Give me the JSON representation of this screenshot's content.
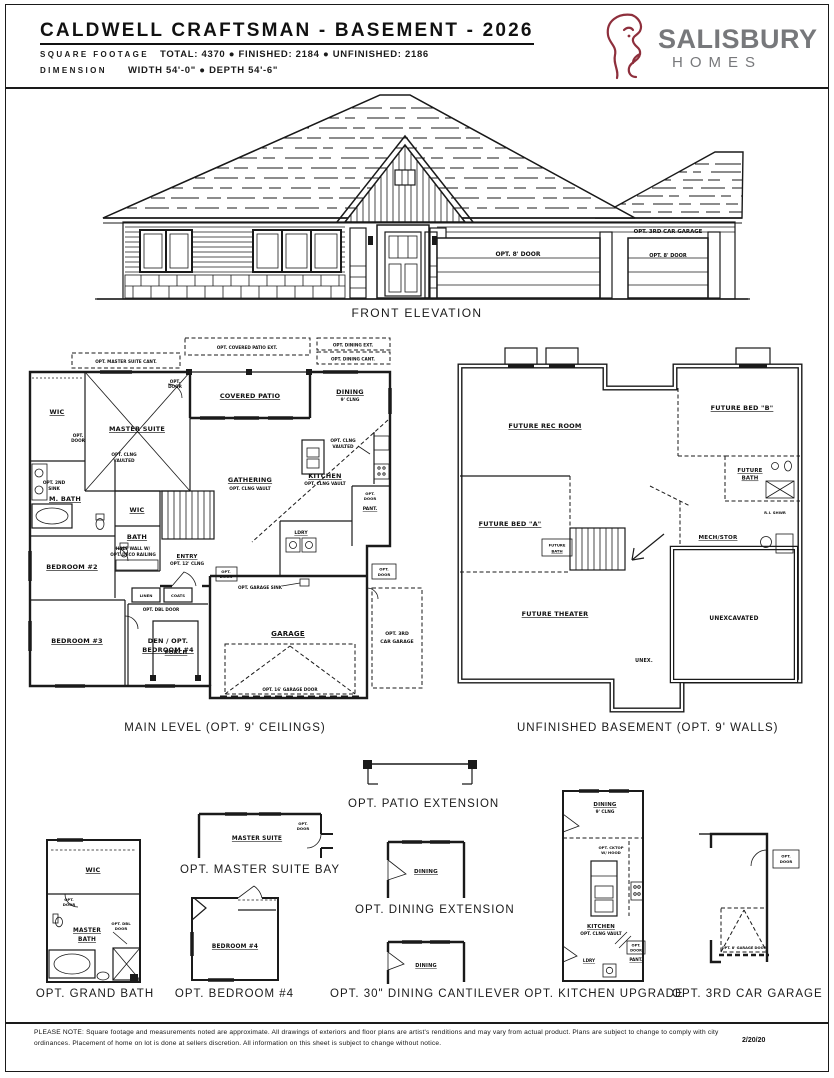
{
  "header": {
    "title": "CALDWELL CRAFTSMAN - BASEMENT - 2026",
    "sqft_label": "SQUARE FOOTAGE",
    "sqft_value": "TOTAL: 4370 ● FINISHED: 2184 ● UNFINISHED: 2186",
    "dim_label": "DIMENSION",
    "dim_value": "WIDTH 54'-0\" ● DEPTH 54'-6\"",
    "brand_name": "SALISBURY",
    "brand_sub": "HOMES",
    "brand_color": "#8e2f3c",
    "brand_text_color": "#77787b"
  },
  "elevation": {
    "caption": "FRONT ELEVATION",
    "opt_3rd_car": "OPT. 3RD CAR GARAGE",
    "opt_door_main": "OPT. 8' DOOR",
    "opt_door_3rd": "OPT. 8' DOOR"
  },
  "main_level": {
    "caption": "MAIN LEVEL (OPT. 9' CEILINGS)",
    "strip_master_cant": "OPT. MASTER SUITE CANT.",
    "strip_patio_ext": "OPT. COVERED PATIO EXT.",
    "strip_dining_ext": "OPT. DINING EXT.",
    "strip_dining_cant": "OPT. DINING CANT.",
    "wic": "WIC",
    "master_suite": "MASTER SUITE",
    "opt_clng_1": "OPT. CLNG",
    "opt_clng_2": "VAULTED",
    "covered_patio": "COVERED PATIO",
    "dining": "DINING",
    "dining_sub": "9' CLNG",
    "gathering": "GATHERING",
    "gathering_sub": "OPT. CLNG VAULT",
    "kitchen": "KITCHEN",
    "kitchen_sub": "OPT. CLNG VAULT",
    "m_bath": "M. BATH",
    "opt_2nd_sink_1": "OPT. 2ND",
    "opt_2nd_sink_2": "SINK",
    "opt_door_1": "OPT.",
    "opt_door_2": "DOOR",
    "wic2": "WIC",
    "bath": "BATH",
    "bedroom2": "BEDROOM #2",
    "bedroom3": "BEDROOM #3",
    "den_1": "DEN / OPT.",
    "den_2": "BEDROOM #4",
    "linen": "LINEN",
    "coats": "COATS",
    "opt_dbl_door": "OPT. DBL DOOR",
    "entry": "ENTRY",
    "entry_sub": "OPT. 12' CLNG",
    "half_wall_1": "HALF WALL W/",
    "half_wall_2": "OPT. DECO RAILING",
    "ldry": "LDRY",
    "pant": "PANT.",
    "garage": "GARAGE",
    "opt_garage_sink": "OPT. GARAGE SINK",
    "opt_garage_door": "OPT. 16' GARAGE DOOR",
    "porch": "PORCH",
    "third_car_1": "OPT. 3RD",
    "third_car_2": "CAR GARAGE"
  },
  "basement": {
    "caption": "UNFINISHED BASEMENT (OPT. 9' WALLS)",
    "rec_room": "FUTURE REC ROOM",
    "bed_b": "FUTURE BED \"B\"",
    "bath_1": "FUTURE",
    "bath_2": "BATH",
    "ri_shwr": "R.I. SHWR",
    "mech": "MECH/STOR",
    "bed_a": "FUTURE BED \"A\"",
    "bath_small_1": "FUTURE",
    "bath_small_2": "BATH",
    "theater": "FUTURE THEATER",
    "unexcavated": "UNEXCAVATED",
    "unex": "UNEX."
  },
  "options": {
    "grand_bath": {
      "caption": "OPT. GRAND BATH",
      "wic": "WIC",
      "opt_door_1": "OPT.",
      "opt_door_2": "DOOR",
      "room_1": "MASTER",
      "room_2": "BATH",
      "dbl_1": "OPT. DBL",
      "dbl_2": "DOOR"
    },
    "master_bay": {
      "caption": "OPT. MASTER SUITE BAY",
      "room": "MASTER SUITE",
      "opt_door_1": "OPT.",
      "opt_door_2": "DOOR"
    },
    "bedroom4": {
      "caption": "OPT. BEDROOM #4",
      "room": "BEDROOM #4"
    },
    "patio_ext": {
      "caption": "OPT. PATIO EXTENSION"
    },
    "dining_ext": {
      "caption": "OPT. DINING EXTENSION",
      "room": "DINING"
    },
    "dining_cant": {
      "caption": "OPT. 30\" DINING CANTILEVER",
      "room": "DINING"
    },
    "kitchen_upg": {
      "caption": "OPT. KITCHEN UPGRADE",
      "dining": "DINING",
      "dining_sub": "9' CLNG",
      "cab_1": "OPT. CKTOP",
      "cab_2": "W/ HOOD",
      "kitchen": "KITCHEN",
      "kitchen_sub": "OPT. CLNG VAULT",
      "opt_door_1": "OPT.",
      "opt_door_2": "DOOR",
      "pant": "PANT.",
      "ldry": "LDRY"
    },
    "third_garage": {
      "caption": "OPT. 3RD CAR GARAGE",
      "opt_door_1": "OPT.",
      "opt_door_2": "DOOR",
      "garage_door": "OPT. 8' GARAGE DOOR"
    }
  },
  "footer": {
    "note": "PLEASE NOTE: Square footage and measurements noted are approximate. All drawings of exteriors and floor plans are artist's renditions and may vary from actual product. Plans are subject to change to comply with city ordinances. Placement of home on lot is done at sellers discretion. All information on this sheet is subject to change without notice.",
    "date": "2/20/20"
  }
}
